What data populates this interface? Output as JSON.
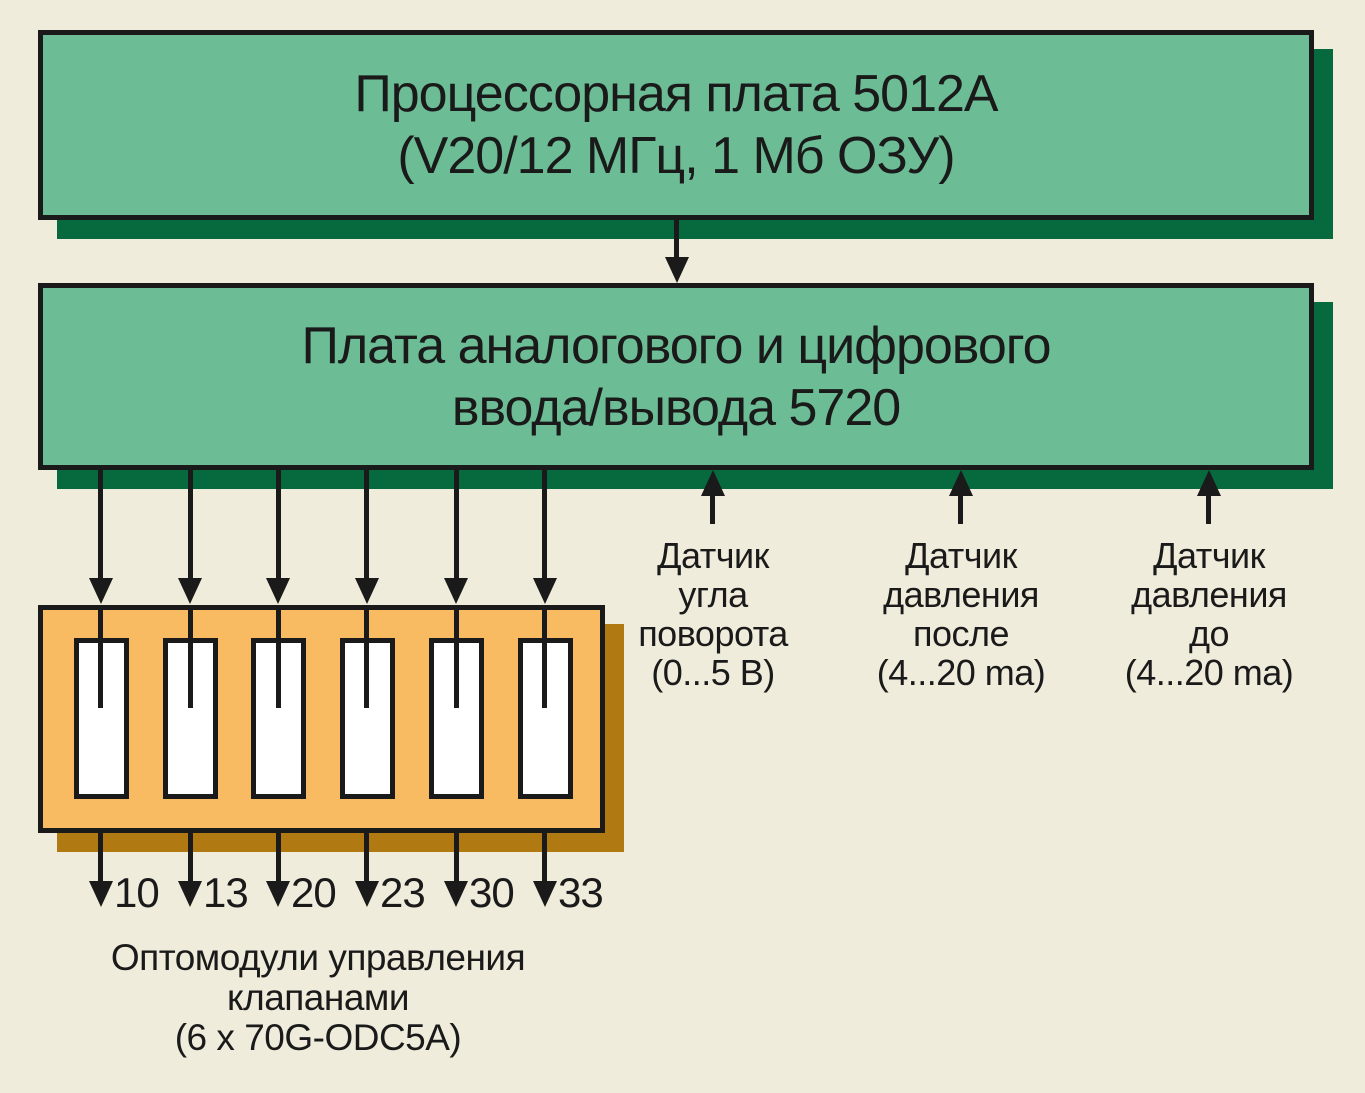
{
  "boards": {
    "processor": {
      "line1": "Процессорная плата 5012А",
      "line2": "(V20/12 МГц, 1 Мб ОЗУ)"
    },
    "io": {
      "line1": "Плата аналогового и цифрового",
      "line2": "ввода/вывода 5720"
    }
  },
  "sensors": [
    {
      "lines": [
        "Датчик",
        "угла",
        "поворота",
        "(0...5 В)"
      ]
    },
    {
      "lines": [
        "Датчик",
        "давления",
        "после",
        "(4...20 ma)"
      ]
    },
    {
      "lines": [
        "Датчик",
        "давления",
        "до",
        "(4...20 ma)"
      ]
    }
  ],
  "valve_outputs": [
    "10",
    "13",
    "20",
    "23",
    "30",
    "33"
  ],
  "caption": {
    "line1": "Оптомодули управления",
    "line2": "клапанами",
    "line3": "(6 x 70G-ODC5A)"
  },
  "colors": {
    "background": "#EFECDB",
    "board_fill": "#6CBD96",
    "board_shadow": "#07693E",
    "module_fill": "#F8BB62",
    "module_shadow": "#B17912",
    "ink": "#1A1A1A",
    "slot_fill": "#FFFFFF"
  }
}
